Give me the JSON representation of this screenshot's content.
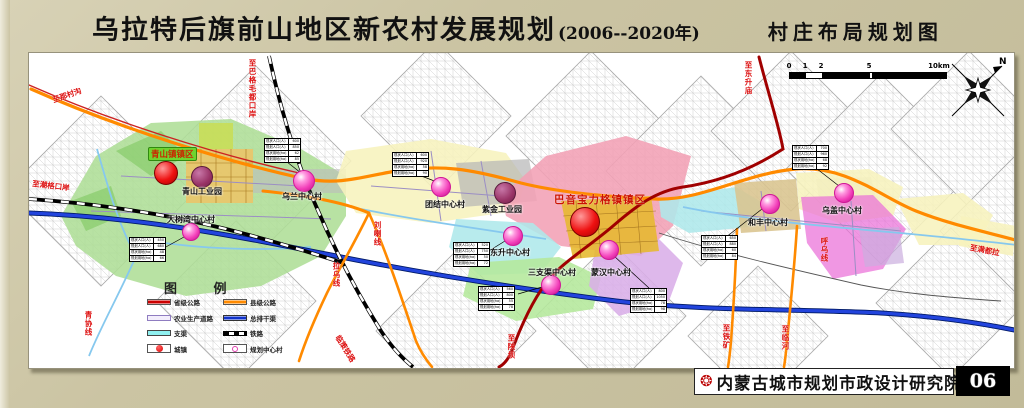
{
  "title": {
    "main": "乌拉特后旗前山地区新农村发展规划",
    "period": "(2006--2020年)",
    "sheet": "村庄布局规划图"
  },
  "footer": {
    "institute": "内蒙古城市规划市政设计研究院",
    "page_no": "06"
  },
  "compass": {
    "north_label": "N"
  },
  "scale_bar": {
    "ticks": [
      "0",
      "1",
      "2",
      "5",
      "10km"
    ]
  },
  "legend": {
    "title": "图 例",
    "items": [
      {
        "label": "省级公路",
        "type": "road-provincial",
        "color": "#cc0000"
      },
      {
        "label": "县级公路",
        "type": "road-county",
        "color": "#ff8a00"
      },
      {
        "label": "农业生产道路",
        "type": "farm-road",
        "color": "#9b8ec4"
      },
      {
        "label": "总排干渠",
        "type": "main-drain",
        "color": "#1133cc"
      },
      {
        "label": "支渠",
        "type": "branch-canal",
        "color": "#8ff0f0"
      },
      {
        "label": "铁路",
        "type": "railway",
        "color": "#000000"
      },
      {
        "label": "城镇",
        "type": "town",
        "color": "#dd1111"
      },
      {
        "label": "规划中心村",
        "type": "central-village",
        "color": "#e040b0"
      }
    ]
  },
  "map": {
    "towns": [
      {
        "name": "青山镇镇区",
        "label_style": "boxed",
        "lx": 147,
        "ly": 146,
        "cx": 165,
        "cy": 172,
        "r": 12
      },
      {
        "name": "巴音宝力格镇镇区",
        "label_style": "red",
        "lx": 553,
        "ly": 191,
        "cx": 584,
        "cy": 221,
        "r": 15
      }
    ],
    "industrial_parks": [
      {
        "name": "青山工业园",
        "cx": 201,
        "cy": 176,
        "r": 11,
        "lx": 181,
        "ly": 185
      },
      {
        "name": "紫金工业园",
        "cx": 504,
        "cy": 192,
        "r": 11,
        "lx": 481,
        "ly": 203
      }
    ],
    "villages": [
      {
        "name": "乌兰中心村",
        "cx": 303,
        "cy": 180,
        "r": 11,
        "lx": 281,
        "ly": 190
      },
      {
        "name": "大树湾中心村",
        "cx": 190,
        "cy": 231,
        "r": 9,
        "lx": 166,
        "ly": 213
      },
      {
        "name": "团结中心村",
        "cx": 440,
        "cy": 186,
        "r": 10,
        "lx": 424,
        "ly": 198
      },
      {
        "name": "东升中心村",
        "cx": 512,
        "cy": 235,
        "r": 10,
        "lx": 489,
        "ly": 246
      },
      {
        "name": "三支渠中心村",
        "cx": 550,
        "cy": 284,
        "r": 10,
        "lx": 527,
        "ly": 266
      },
      {
        "name": "蒙汉中心村",
        "cx": 608,
        "cy": 249,
        "r": 10,
        "lx": 590,
        "ly": 266
      },
      {
        "name": "和丰中心村",
        "cx": 769,
        "cy": 203,
        "r": 10,
        "lx": 747,
        "ly": 216
      },
      {
        "name": "乌盖中心村",
        "cx": 843,
        "cy": 192,
        "r": 10,
        "lx": 821,
        "ly": 204
      }
    ],
    "info_table_rows": [
      "现状人口(人)",
      "规划人口(人)",
      "现状用地(ha)",
      "规划用地(ha)"
    ],
    "info_tables": [
      {
        "x": 263,
        "y": 137,
        "values": [
          "600",
          "850",
          "62",
          "85"
        ]
      },
      {
        "x": 128,
        "y": 236,
        "values": [
          "450",
          "680",
          "48",
          "66"
        ]
      },
      {
        "x": 391,
        "y": 151,
        "values": [
          "600",
          "920",
          "58",
          "90"
        ]
      },
      {
        "x": 452,
        "y": 241,
        "values": [
          "520",
          "750",
          "50",
          "72"
        ]
      },
      {
        "x": 477,
        "y": 285,
        "values": [
          "560",
          "800",
          "55",
          "78"
        ]
      },
      {
        "x": 629,
        "y": 287,
        "values": [
          "800",
          "1050",
          "78",
          "98"
        ]
      },
      {
        "x": 700,
        "y": 234,
        "values": [
          "650",
          "880",
          "60",
          "84"
        ]
      },
      {
        "x": 791,
        "y": 144,
        "values": [
          "700",
          "960",
          "68",
          "92"
        ]
      }
    ],
    "road_labels": [
      {
        "text": "至那村沟",
        "x": 50,
        "y": 94,
        "rot": -19
      },
      {
        "text": "至巴格毛都口岸",
        "x": 246,
        "y": 58,
        "vertical": true
      },
      {
        "text": "至潮格口岸",
        "x": 32,
        "y": 177,
        "rot": 7
      },
      {
        "text": "青协线",
        "x": 82,
        "y": 310,
        "vertical": true
      },
      {
        "text": "刘喇线",
        "x": 371,
        "y": 220,
        "vertical": true
      },
      {
        "text": "拉乌线",
        "x": 330,
        "y": 261,
        "vertical": true
      },
      {
        "text": "至陕坝",
        "x": 505,
        "y": 333,
        "vertical": true
      },
      {
        "text": "临策铁路",
        "x": 341,
        "y": 332,
        "rot": 58
      },
      {
        "text": "至东升庙",
        "x": 742,
        "y": 60,
        "vertical": true
      },
      {
        "text": "呼乌线",
        "x": 818,
        "y": 236,
        "vertical": true
      },
      {
        "text": "至铁矿",
        "x": 720,
        "y": 323,
        "vertical": true
      },
      {
        "text": "至临河",
        "x": 779,
        "y": 324,
        "vertical": true
      },
      {
        "text": "至满都拉",
        "x": 970,
        "y": 241,
        "rot": 11
      }
    ]
  }
}
